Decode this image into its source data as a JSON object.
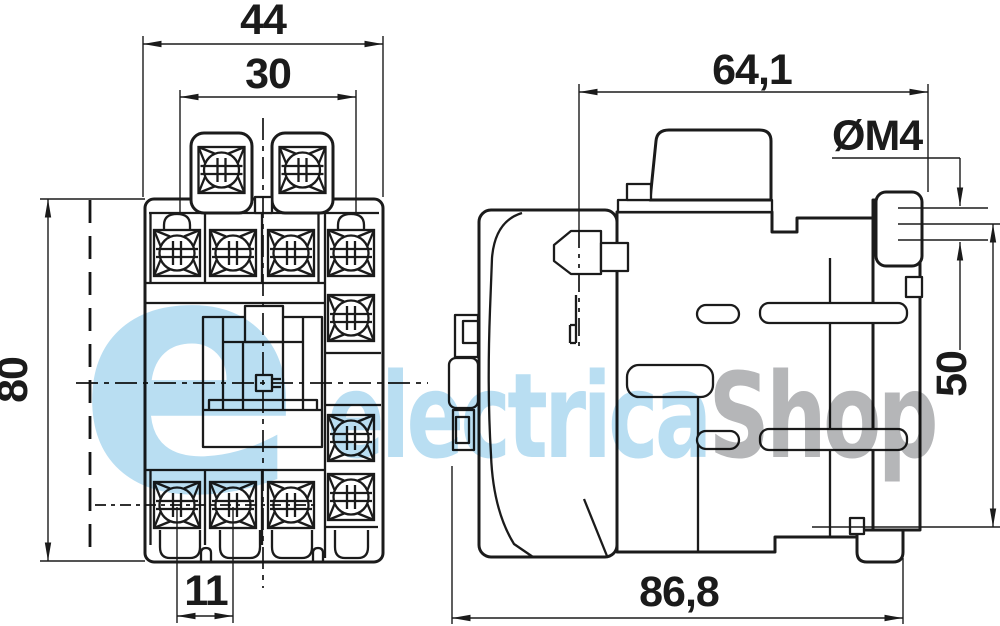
{
  "dimensions": {
    "front_overall_width": "44",
    "front_terminal_width": "30",
    "front_overall_height": "80",
    "front_terminal_pitch": "11",
    "side_upper_depth": "64,1",
    "side_overall_depth": "86,8",
    "mounting_hole_thread": "ØM4",
    "mounting_hole_pitch": "50"
  },
  "watermark": {
    "logo_letter": "e",
    "brand_primary": "electrica",
    "brand_secondary": "Shop"
  },
  "colors": {
    "line": "#1b1b1b",
    "watermark_blue": "#b9def2",
    "watermark_gray": "#b5b6b8",
    "background": "#ffffff"
  }
}
